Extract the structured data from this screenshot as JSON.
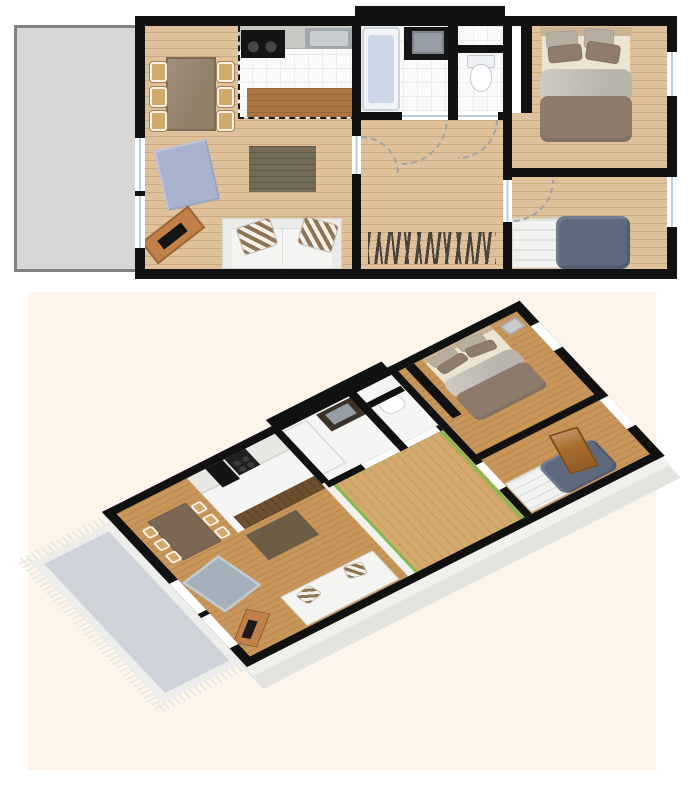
{
  "title": "apartment-floor-plan",
  "views": {
    "plan_2d": {
      "rooms": [
        "terrace",
        "living-room",
        "kitchen",
        "bathroom",
        "wc",
        "hallway",
        "bedroom-master",
        "bedroom-single"
      ],
      "furniture": [
        "dining-table",
        "six-chairs",
        "blue-rug",
        "dark-rug",
        "sofa-with-striped-cushions",
        "sideboard",
        "kitchen-counter",
        "stove",
        "kitchen-sink",
        "breakfast-bar",
        "bathtub",
        "vanity-sink",
        "toilet",
        "striped-runner-rug",
        "double-bed",
        "single-bed"
      ]
    },
    "plan_3d": {
      "rooms": [
        "terrace-fringed-rug",
        "living-room",
        "kitchen",
        "bathroom",
        "wc",
        "hallway",
        "bedroom-master",
        "bedroom-single"
      ],
      "furniture": [
        "dining-table",
        "chairs",
        "kitchen-cabinets",
        "oven",
        "cooktop",
        "breakfast-bar",
        "dark-rug",
        "blue-gray-rug",
        "sofa",
        "sideboard",
        "vanity-sink",
        "bathtub",
        "toilet",
        "double-bed",
        "single-bed",
        "open-wooden-door",
        "wall-vent"
      ]
    }
  },
  "colors": {
    "page_bg": "#ffffff",
    "wall": "#111111",
    "terrace_fill": "#d7d7d7",
    "terrace_border": "#828282",
    "wood": "#dfc29c",
    "wood_line": "rgba(150,105,55,0.28)",
    "tile": "#fafafa",
    "tile_line": "#ececec",
    "counter": "#c9c7c1",
    "appliance": "#141414",
    "sink_outer": "#a2a7ad",
    "sink_inner": "#c9ced3",
    "bar": "#aa7540",
    "tub_rim": "#f1f3f6",
    "tub_fill": "#ccd8e8",
    "vanity": "#161616",
    "vanity_sink": "#969da5",
    "wc_fill": "#eef0f3",
    "rug_blue": "#a9b2cf",
    "rug_dark": "#746c58",
    "sofa": "#f4f4f2",
    "cushion_stripe": "#8e7354",
    "sideboard": "#c08047",
    "bed_headboard": "#cab494",
    "bed_sheet": "#ebe4d2",
    "pillow_gray": "#b6aea0",
    "pillow_brown": "#8e7d6d",
    "duvet_gray": "#b9b5ad",
    "duvet_brown": "#8c7b6d",
    "single_bed_white": "#f2f2f0",
    "single_bed_blue": "#5d6a7e",
    "rug_stripe": "#34332e",
    "window_line": "#b9cede",
    "cream_bg": "#fdf4ea",
    "extrude": "#e3e3e0",
    "extrude_light": "#f0f0ed",
    "wood3d": "#c9965a",
    "hall_wood3d": "#d4a96e",
    "green_accent": "#72bf44",
    "door_wood": "#a96d2d",
    "chair": "#d2a96b",
    "terrace3d_fill": "#cdd3d8",
    "terrace3d_band": "#ededeb",
    "fringe": "#e9e7e2",
    "cabinet3d": "#e9e7e3",
    "bar3d": "#6e4f2d",
    "rug_dark3d": "#6b5d45",
    "rug_blue3d": "#a3b0ba",
    "table3d": "#7b6753"
  }
}
